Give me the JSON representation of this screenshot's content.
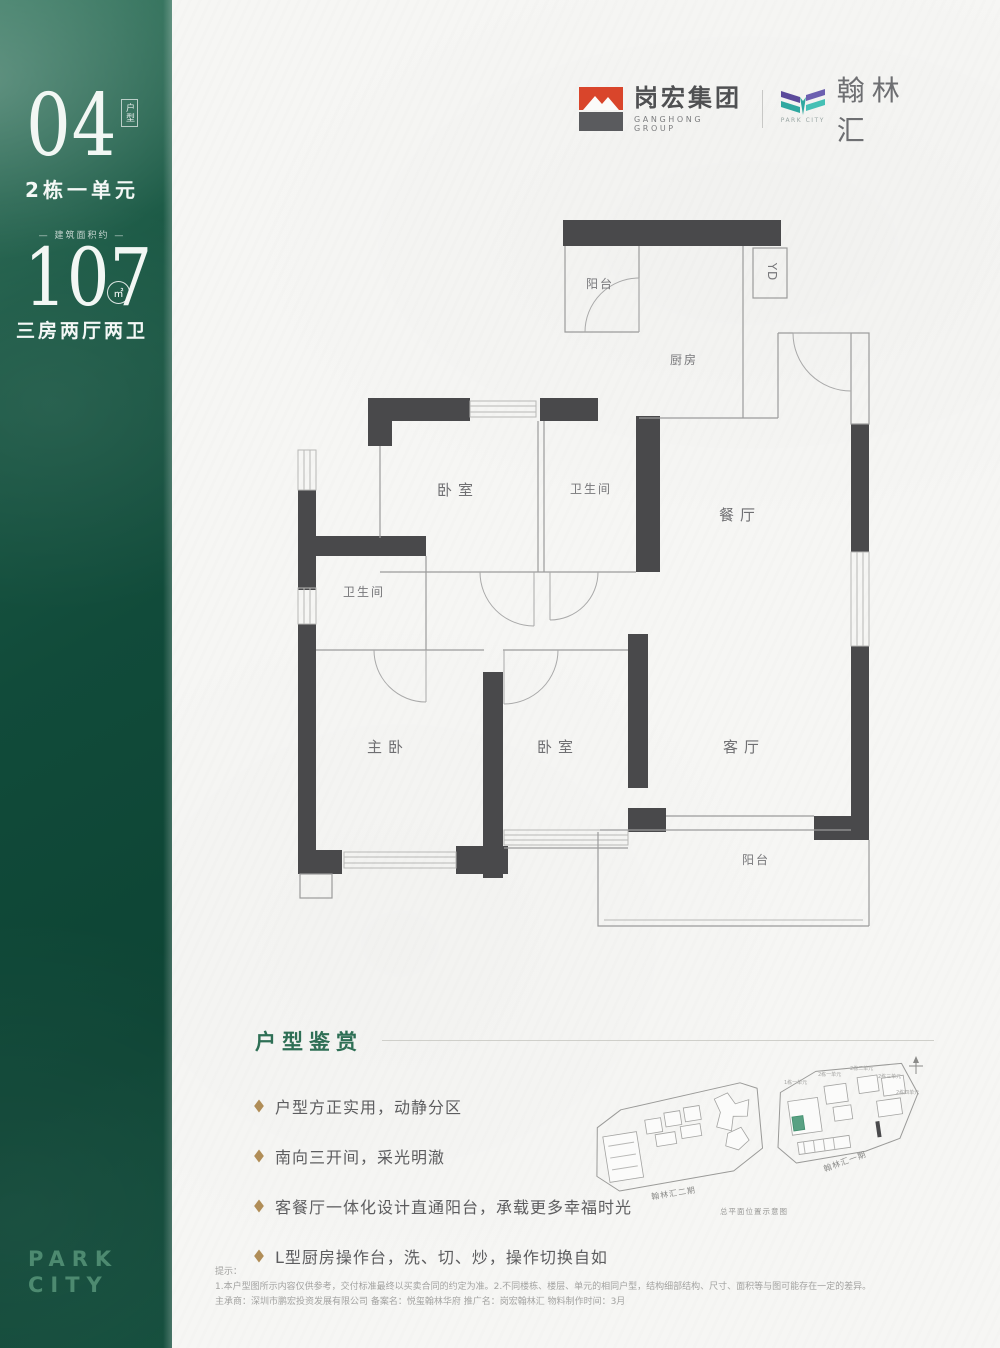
{
  "sidebar": {
    "unit_number": "04",
    "unit_tag": "户型",
    "building": "2栋一单元",
    "area_label": "— 建筑面积约 —",
    "area_value": "107",
    "area_unit": "㎡",
    "layout": "三房两厅两卫",
    "brand_line1": "PARK",
    "brand_line2": "CITY"
  },
  "header": {
    "ganghong_name": "岗宏集团",
    "ganghong_sub": "GANGHONG GROUP",
    "hanlin_name": "翰林汇",
    "hanlin_sub": "PARK CITY"
  },
  "floorplan": {
    "rooms": {
      "balcony_top": "阳台",
      "yd": "YD",
      "kitchen": "厨房",
      "dining": "餐厅",
      "bedroom_top": "卧室",
      "bath_top": "卫生间",
      "bath_left": "卫生间",
      "master": "主卧",
      "bedroom_bottom": "卧室",
      "living": "客厅",
      "balcony_bottom": "阳台"
    }
  },
  "appreciation": {
    "title": "户型鉴赏",
    "bullets": [
      "户型方正实用，动静分区",
      "南向三开间，采光明澈",
      "客餐厅一体化设计直通阳台，承载更多幸福时光",
      "L型厨房操作台，洗、切、炒，操作切换自如"
    ]
  },
  "siteplan": {
    "phase2_label": "翰林汇二期",
    "phase1_label": "翰林汇一期",
    "caption": "总平面位置示意图",
    "buildings": [
      "1栋一单元",
      "2栋一单元",
      "2栋二单元",
      "2栋三单元",
      "2栋四单元"
    ]
  },
  "disclaimer": {
    "title": "提示：",
    "line1": "1.本户型图所示内容仅供参考，交付标准最终以买卖合同的约定为准。2.不同楼栋、楼层、单元的相同户型，结构细部结构、尺寸、面积等与图可能存在一定的差异。",
    "line2": "主承商：深圳市鹏宏投资发展有限公司 备案名：悦玺翰林华府 推广名：岗宏翰林汇 物料制作时间：3月"
  },
  "colors": {
    "sidebar_green": "#114b3a",
    "brand_green": "#4d8a70",
    "title_green": "#2e6f55",
    "bullet_gold": "#b08d57",
    "wall_gray": "#49494b",
    "logo_red": "#d9452b",
    "hanlin_purple": "#5b4a9b",
    "hanlin_teal": "#2fa8a0"
  }
}
